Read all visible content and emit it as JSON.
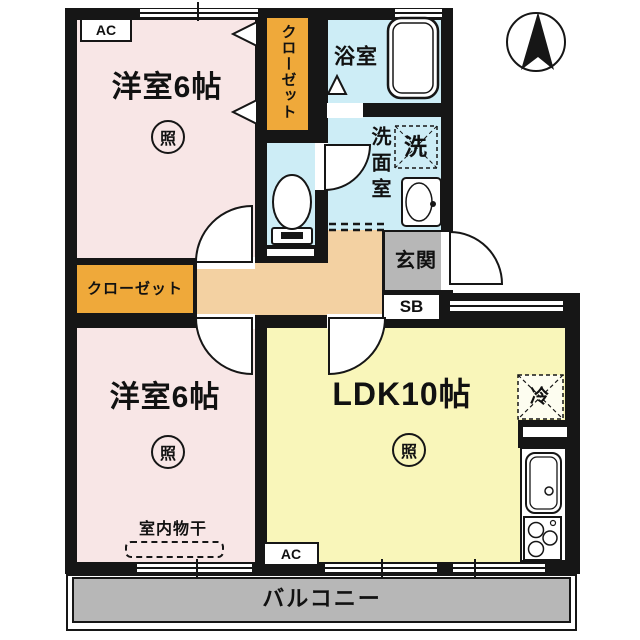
{
  "rooms": {
    "bedroom1": {
      "name": "洋室6帖",
      "light": "照"
    },
    "bedroom2": {
      "name": "洋室6帖",
      "light": "照",
      "drying": "室内物干"
    },
    "ldk": {
      "name": "LDK10帖",
      "light": "照"
    },
    "bath": {
      "name": "浴室"
    },
    "washroom": {
      "name": "洗面室",
      "washer": "洗"
    },
    "entrance": {
      "name": "玄関",
      "shoebox": "SB"
    },
    "kitchen": {
      "fridge": "冷"
    },
    "closet_top": {
      "name": "クローゼット"
    },
    "closet_left": {
      "name": "クローゼット"
    },
    "balcony": {
      "name": "バルコニー"
    }
  },
  "marks": {
    "ac_top": "AC",
    "ac_bottom": "AC"
  },
  "colors": {
    "wall": "#161616",
    "bedroom_floor": "#f8e6e6",
    "ldk_floor": "#f9f6ba",
    "wet_area_floor": "#cdedf6",
    "closet_floor": "#efa93a",
    "hall_floor": "#f3d1a2",
    "entrance_floor": "#b7b7b7",
    "balcony_floor": "#b7b7b7"
  }
}
